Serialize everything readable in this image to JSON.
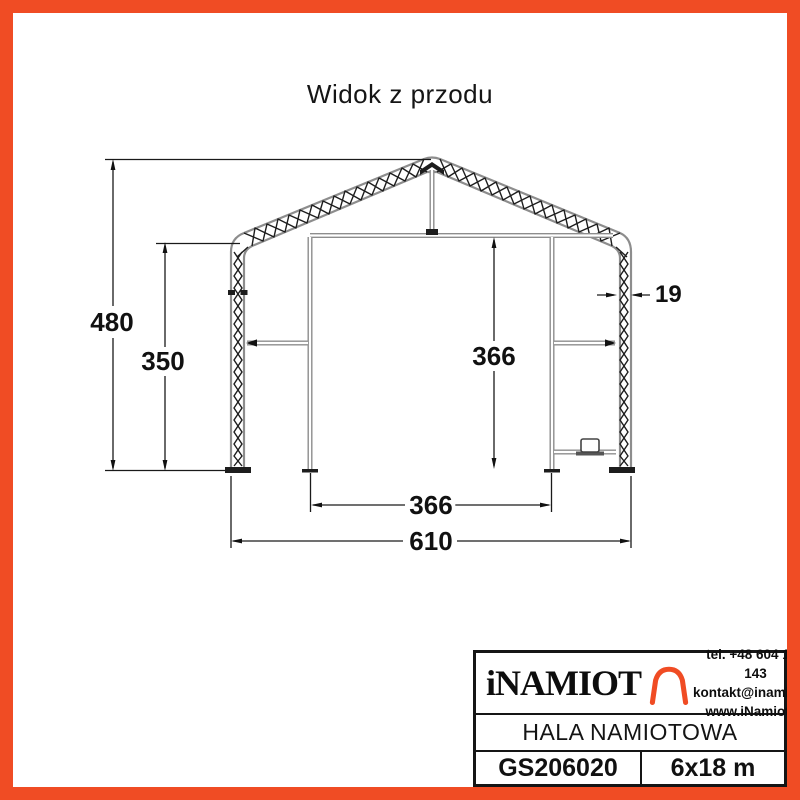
{
  "page": {
    "title": "Widok z przodu"
  },
  "drawing": {
    "name": "tent-hall-front-elevation",
    "dimensions": {
      "total_height": "480",
      "side_height": "350",
      "inner_height": "366",
      "truss_thickness": "19",
      "inner_width": "366",
      "total_width": "610"
    }
  },
  "title_block": {
    "brand": "iNAMIOT",
    "phone": "tel. +48 604 108 143",
    "email": "kontakt@inamiot.pl",
    "website": "www.iNamiot.pl",
    "product_name": "HALA NAMIOTOWA",
    "model_code": "GS206020",
    "size": "6x18 m"
  },
  "colors": {
    "accent_orange": "#F04C24",
    "structure_gray": "#8d8d8d",
    "ink_black": "#1a1a1a"
  }
}
